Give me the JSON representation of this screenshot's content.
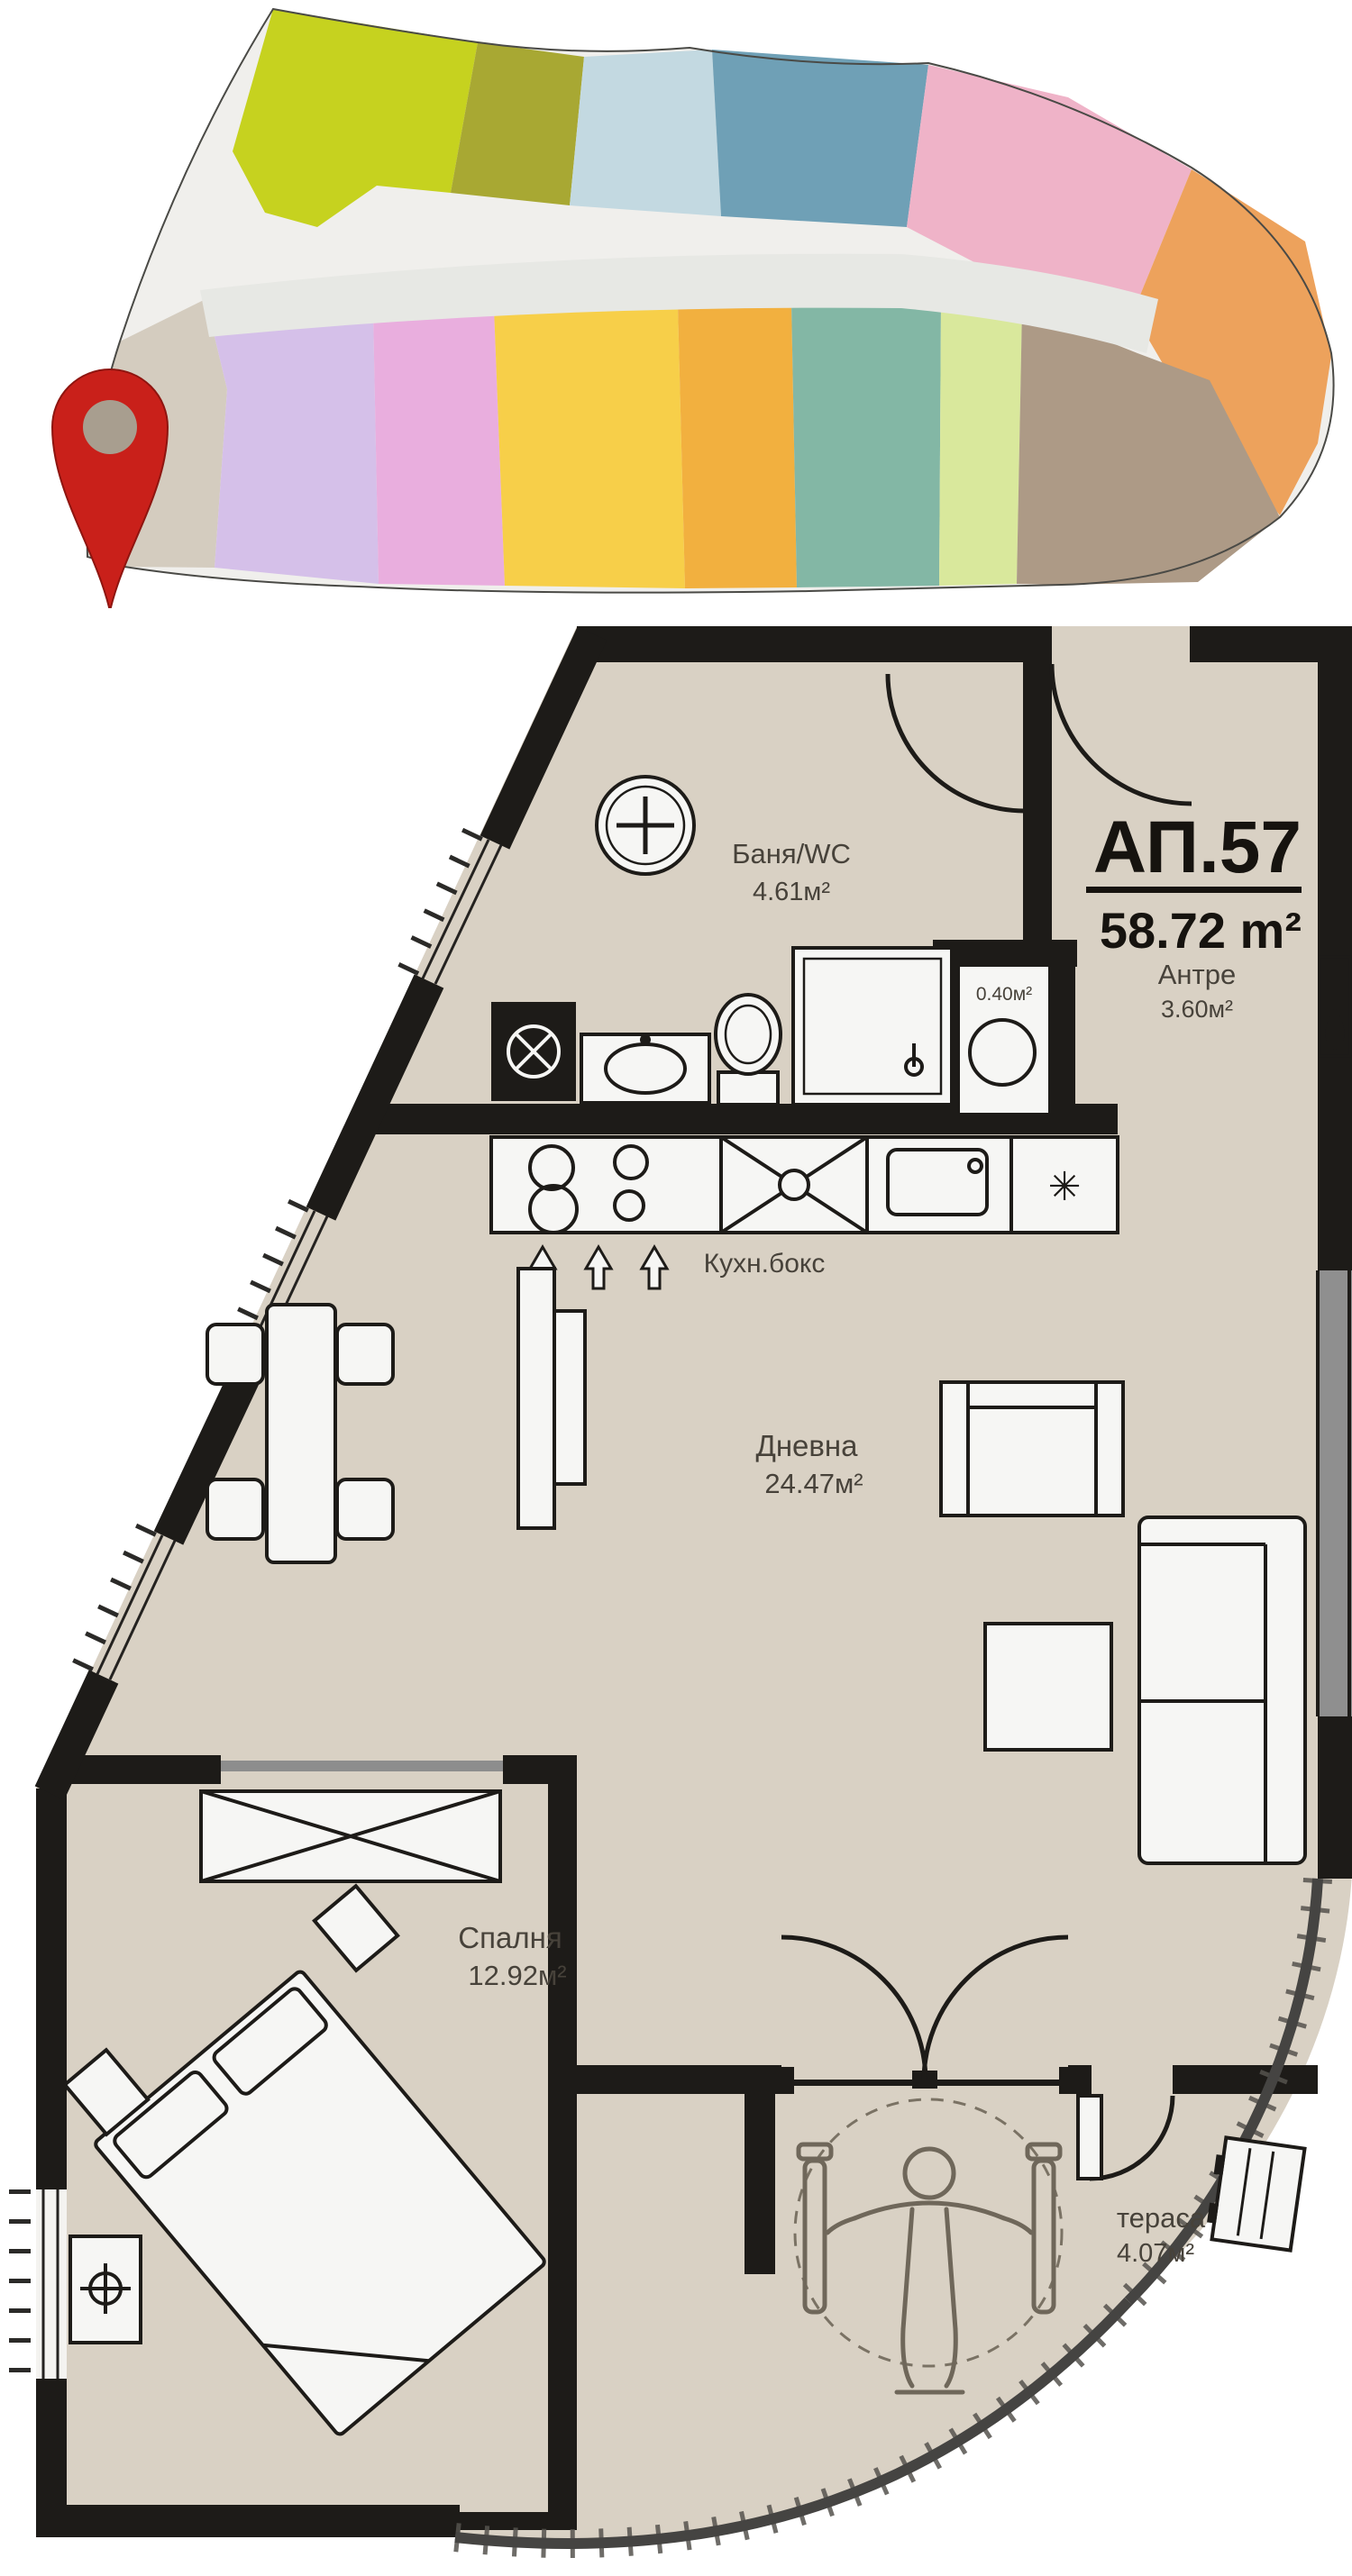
{
  "page": {
    "background": "#ffffff"
  },
  "overview": {
    "base_color": "#f0efec",
    "corridor_color": "#e7e8e4",
    "pin": {
      "color": "#c9201a",
      "hole_color": "#a89e8f"
    },
    "apartments": {
      "chartreuse": "#c6d21f",
      "olive": "#a8a833",
      "pale_blue": "#c3d9e1",
      "steel_blue": "#6fa0b6",
      "pink": "#efb3c8",
      "orange_right": "#eda25c",
      "beige_selected": "#d4ccbf",
      "lavender": "#d5c0e9",
      "orchid": "#e9aede",
      "yellow": "#f7cf49",
      "amber": "#f2b03f",
      "teal_green": "#83b7a5",
      "lime": "#d9e89c",
      "taupe": "#ad9a86"
    }
  },
  "plan": {
    "apartment_id": "АП.57",
    "total_area": "58.72 m²",
    "colors": {
      "floor": "#d9d1c4",
      "wall": "#1d1b18",
      "fixture": "#f6f6f4",
      "label": "#47423a",
      "title": "#16130f",
      "glass": "#8f8f8f",
      "accessory": "#6f675a"
    },
    "rooms": {
      "bathroom": {
        "name": "Баня/WC",
        "area": "4.61м²"
      },
      "entry": {
        "name": "Антре",
        "area": "3.60м²"
      },
      "shaft": {
        "area": "0.40м²"
      },
      "kitchen": {
        "name": "Кухн.бокс"
      },
      "living": {
        "name": "Дневна",
        "area": "24.47м²"
      },
      "bedroom": {
        "name": "Спалня",
        "area": "12.92м²"
      },
      "terrace": {
        "name": "тераса",
        "area": "4.07м²"
      }
    },
    "icons": {
      "fridge_glyph": "✳"
    }
  }
}
